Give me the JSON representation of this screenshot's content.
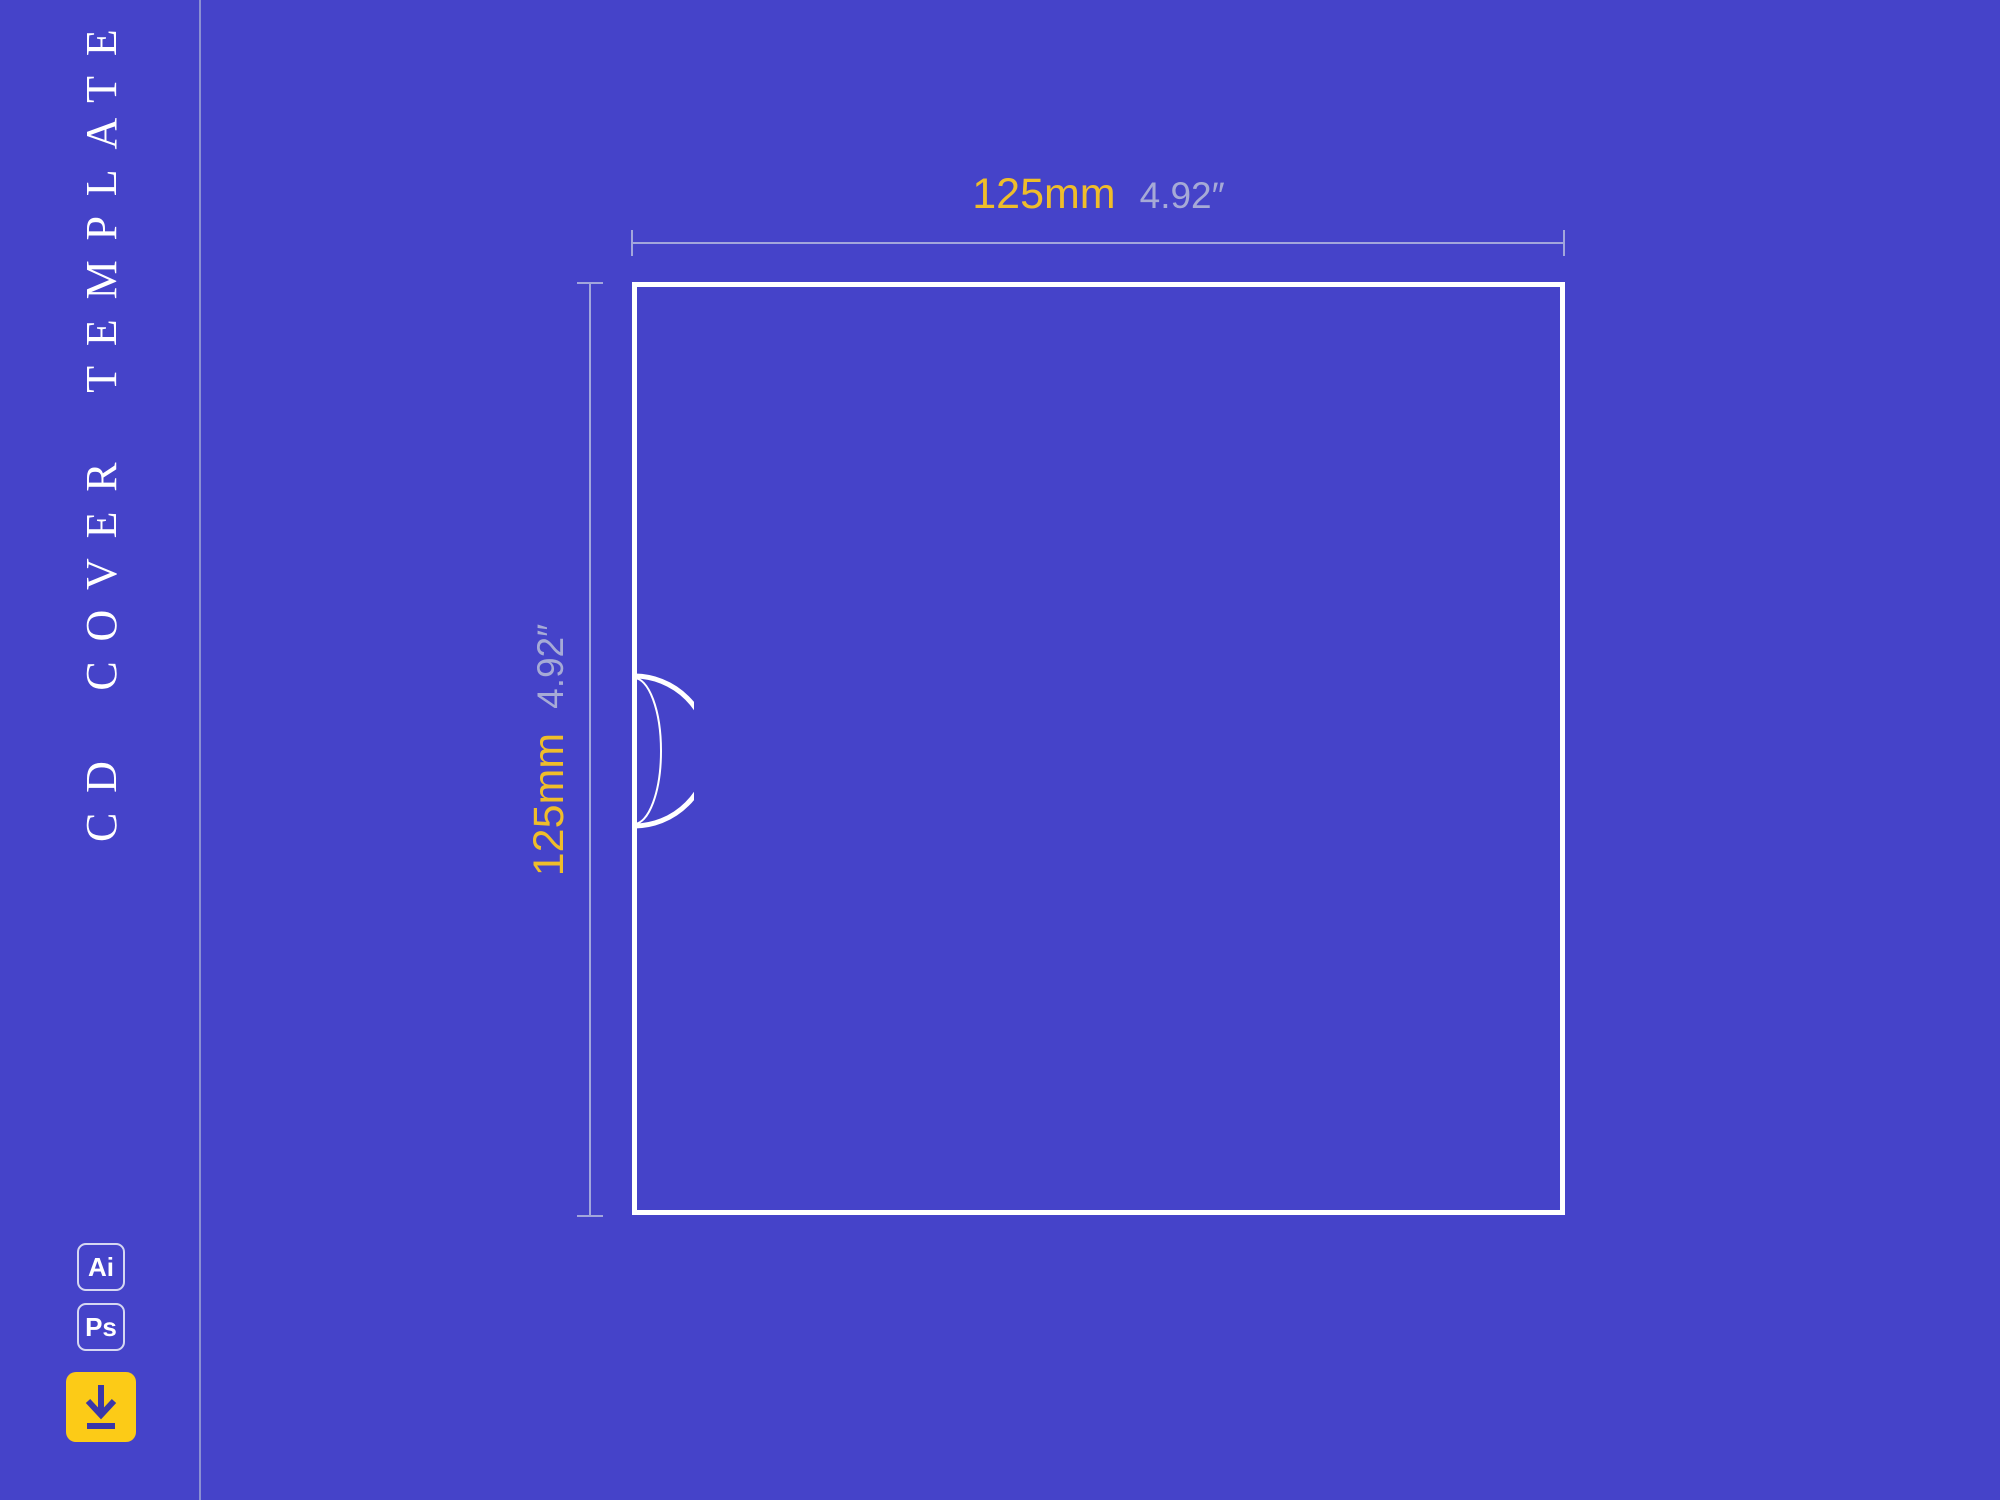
{
  "sidebar": {
    "title": "CD COVER TEMPLATE",
    "format_badges": [
      {
        "label": "Ai",
        "name": "adobe-illustrator"
      },
      {
        "label": "Ps",
        "name": "adobe-photoshop"
      }
    ],
    "download_button": {
      "icon": "download-arrow-icon"
    }
  },
  "diagram": {
    "shape": "cd-cover-square-outline-with-thumb-notch",
    "width_dimension": {
      "metric": "125mm",
      "imperial": "4.92″"
    },
    "height_dimension": {
      "metric": "125mm",
      "imperial": "4.92″"
    }
  },
  "colors": {
    "background": "#4543C9",
    "outline_white": "#FFFFFF",
    "divider_lavender": "#8B8FD2",
    "dimension_line": "#A2A6DC",
    "accent_yellow_text": "#EFBD2A",
    "muted_inch_text": "#A6AAD6",
    "download_button_yellow": "#FCCB17",
    "download_arrow_indigo": "#3A37A8"
  }
}
